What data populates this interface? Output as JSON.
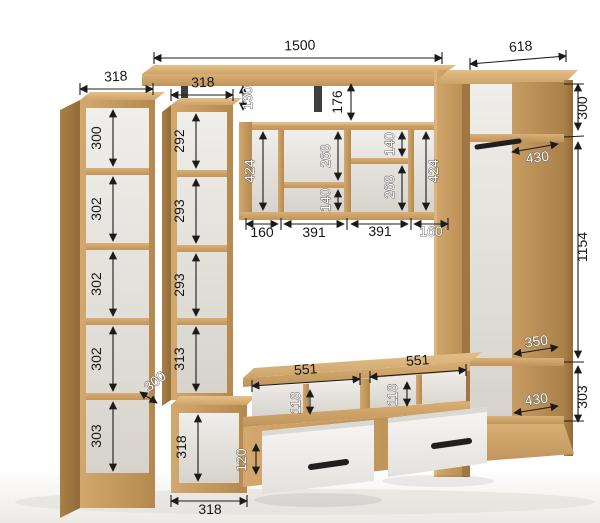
{
  "colors": {
    "wood": "#c89d62",
    "wood_dark": "#a87f47",
    "wood_light": "#e0ba83",
    "panel_back": "#e9e6e1",
    "drawer_front": "#f3f2f0",
    "handle": "#1f1f1f",
    "dim_line": "#1b1b1b",
    "dim_text_dark": "#161616",
    "dim_text_light": "#ffffff",
    "background": "#ffffff"
  },
  "dims": {
    "col_a": {
      "width": "318",
      "cells": [
        "300",
        "302",
        "302",
        "302",
        "303"
      ]
    },
    "col_b": {
      "width": "318",
      "cells": [
        "292",
        "293",
        "293",
        "313"
      ],
      "depth": "300",
      "lower_cell": "318",
      "lower_width": "318"
    },
    "top": {
      "shelf_length": "1500",
      "gap_left": "130",
      "gap_mid": "176"
    },
    "center": {
      "side_left": "424",
      "side_right": "424",
      "left_upper": "268",
      "left_lower": "140",
      "right_upper": "140",
      "right_lower": "268",
      "bottom": [
        "160",
        "391",
        "391",
        "160"
      ]
    },
    "stand": {
      "niche_widths": [
        "551",
        "551"
      ],
      "niche_heights": [
        "118",
        "118"
      ],
      "drawer_front": "120"
    },
    "wardrobe": {
      "width": "618",
      "upper_height": "300",
      "upper_depth": "430",
      "middle_height": "1154",
      "shelf_depth": "350",
      "lower_height": "303",
      "lower_depth": "430"
    }
  }
}
